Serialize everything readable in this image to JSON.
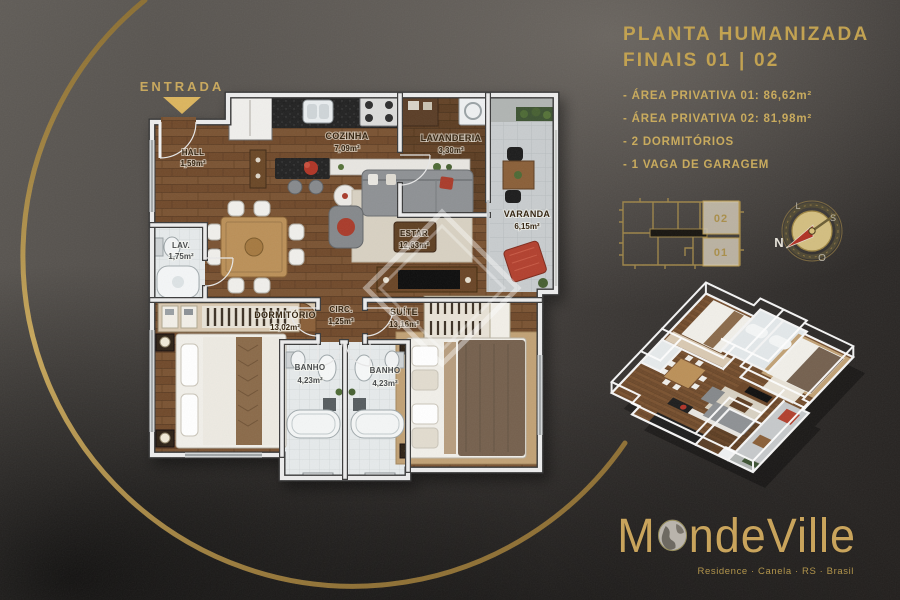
{
  "entrada": {
    "label": "ENTRADA"
  },
  "panel": {
    "title1": "PLANTA HUMANIZADA",
    "title2": "FINAIS 01 | 02",
    "bullets": [
      "- ÁREA PRIVATIVA 01: 86,62m²",
      "- ÁREA PRIVATIVA 02: 81,98m²",
      "- 2 DORMITÓRIOS",
      "- 1 VAGA DE GARAGEM"
    ]
  },
  "keyplan": {
    "unit_top": "02",
    "unit_bottom": "01"
  },
  "compass": {
    "n": "N",
    "s": "S",
    "l": "L",
    "o": "O"
  },
  "floorplan": {
    "rooms": [
      {
        "name": "HALL",
        "area": "1,59m²"
      },
      {
        "name": "COZINHA",
        "area": "7,09m²"
      },
      {
        "name": "LAVANDERIA",
        "area": "3,30m²"
      },
      {
        "name": "VARANDA",
        "area": "6,15m²"
      },
      {
        "name": "ESTAR",
        "area": "12,63m²"
      },
      {
        "name": "LAV.",
        "area": "1,75m²"
      },
      {
        "name": "DORMITÓRIO",
        "area": "13,02m²"
      },
      {
        "name": "CIRC.",
        "area": "1,25m²"
      },
      {
        "name": "SUÍTE",
        "area": "13,16m²"
      },
      {
        "name": "BANHO",
        "area": "4,23m²"
      },
      {
        "name": "BANHO",
        "area": "4,23m²"
      }
    ]
  },
  "logo": {
    "part1": "M",
    "part2": "ndeVille",
    "tagline": "Residence · Canela · RS · Brasil"
  },
  "colors": {
    "gold": "#c5a050",
    "gold_light": "#d8b35e",
    "background_dark": "#2c2927",
    "wood": "#7a5230",
    "accent_red": "#b2402e"
  }
}
